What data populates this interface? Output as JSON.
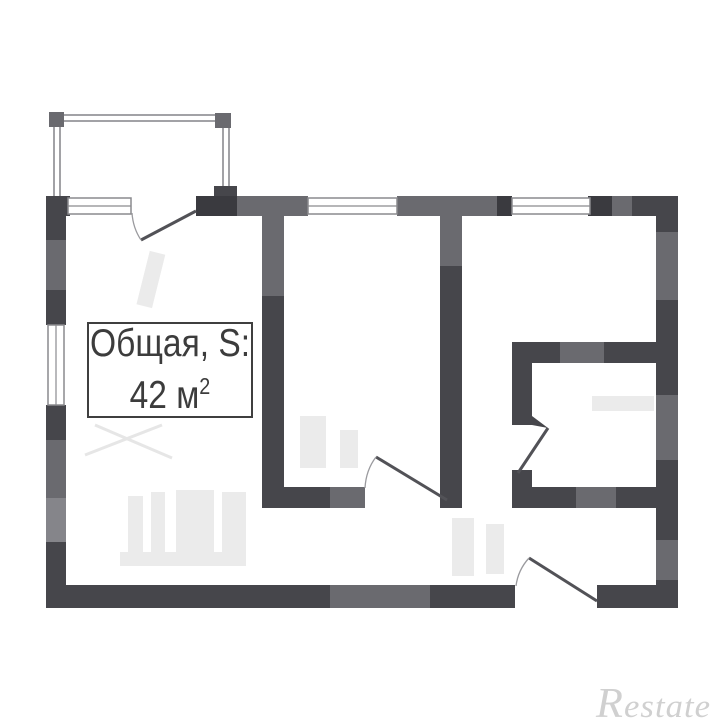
{
  "floorplan": {
    "area_label": {
      "line1": "Общая, S:",
      "area_value": "42 м",
      "area_sup": "2"
    },
    "watermark_text": "Restate",
    "colors": {
      "background": "#ffffff",
      "wall_dark": "#46464b",
      "wall_darker": "#3a3a3f",
      "wall_mid": "#6a6a6f",
      "wall_soft": "#85858a",
      "window_line": "#8a8a8e",
      "balcony_line": "#a2a2a6",
      "door_line": "#525257",
      "arc_line": "#9a9a9e",
      "ghost": "#ebebeb",
      "label_border": "#3f3f3f",
      "label_text": "#3c3c3c",
      "watermark_color": "#d0d0d0"
    }
  }
}
